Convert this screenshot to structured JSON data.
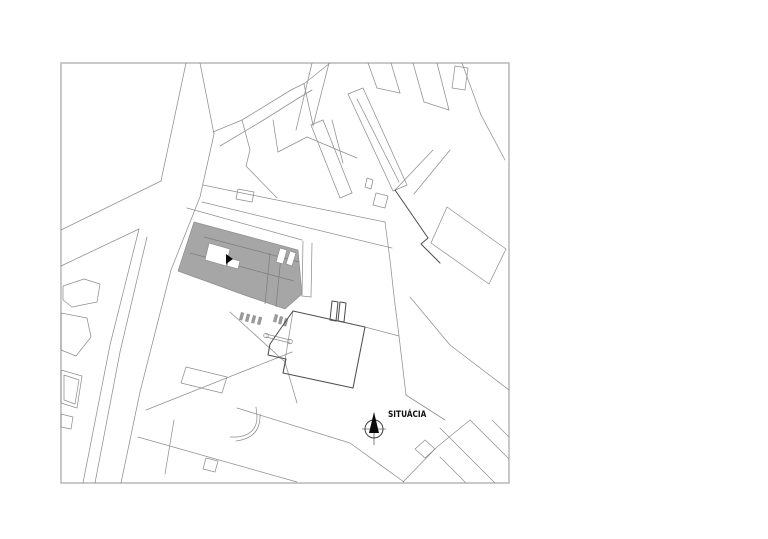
{
  "plan": {
    "label": "SITUÁCIA",
    "colors": {
      "background": "#ffffff",
      "frame_stroke": "#b2b2b2",
      "parcel_stroke": "#8f8f8f",
      "dark_stroke": "#4f4f4f",
      "highlight_fill": "#a6a6a6",
      "ink": "#0a0a0a"
    },
    "geometry": {
      "frame": {
        "x": 61,
        "y": 63,
        "w": 448,
        "h": 420
      },
      "label_pos": {
        "x": 388,
        "y": 417,
        "condense": 0.82
      },
      "north": {
        "cx": 374,
        "cy": 429,
        "r": 9,
        "hline": [
          [
            362,
            429
          ],
          [
            386,
            429
          ]
        ],
        "vline": [
          [
            374,
            413
          ],
          [
            374,
            445
          ]
        ],
        "needle": [
          [
            374,
            412
          ],
          [
            379,
            433
          ],
          [
            369,
            433
          ]
        ]
      },
      "gray_poly": [
        [
          194,
          222
        ],
        [
          298,
          250
        ],
        [
          302,
          294
        ],
        [
          285,
          309
        ],
        [
          247,
          296
        ],
        [
          178,
          271
        ]
      ],
      "white_polys": [
        [
          [
            209,
            243
          ],
          [
            230,
            249
          ],
          [
            226,
            266
          ],
          [
            205,
            260
          ]
        ],
        [
          [
            229,
            258
          ],
          [
            240,
            261
          ],
          [
            238,
            269
          ],
          [
            227,
            266
          ]
        ],
        [
          [
            280,
            248
          ],
          [
            287,
            250
          ],
          [
            283,
            264
          ],
          [
            276,
            262
          ]
        ],
        [
          [
            290,
            251
          ],
          [
            296,
            253
          ],
          [
            292,
            266
          ],
          [
            286,
            264
          ]
        ]
      ],
      "entrance_triangle": [
        [
          226,
          254
        ],
        [
          233,
          259
        ],
        [
          226,
          264
        ]
      ],
      "interior_lines": [
        [
          [
            204,
            237
          ],
          [
            299,
            262
          ]
        ],
        [
          [
            190,
            253
          ],
          [
            294,
            281
          ]
        ],
        [
          [
            270,
            253
          ],
          [
            265,
            304
          ]
        ],
        [
          [
            281,
            256
          ],
          [
            276,
            307
          ]
        ]
      ],
      "lines": [
        [
          [
            186,
            63
          ],
          [
            161,
            181
          ]
        ],
        [
          [
            200,
            63
          ],
          [
            214,
            134
          ]
        ],
        [
          [
            161,
            181
          ],
          [
            61,
            230
          ]
        ],
        [
          [
            139,
            229
          ],
          [
            61,
            266
          ]
        ],
        [
          [
            139,
            229
          ],
          [
            110,
            345
          ],
          [
            83,
            483
          ]
        ],
        [
          [
            147,
            237
          ],
          [
            120,
            352
          ],
          [
            95,
            483
          ]
        ],
        [
          [
            214,
            134
          ],
          [
            200,
            197
          ],
          [
            171,
            270
          ],
          [
            140,
            392
          ],
          [
            121,
            483
          ]
        ],
        [
          [
            213,
            132
          ],
          [
            242,
            120
          ],
          [
            291,
            90
          ],
          [
            305,
            83
          ]
        ],
        [
          [
            305,
            83
          ],
          [
            330,
            63
          ]
        ],
        [
          [
            220,
            146
          ],
          [
            262,
            121
          ],
          [
            297,
            99
          ],
          [
            312,
            90
          ]
        ],
        [
          [
            304,
            84
          ],
          [
            313,
            125
          ]
        ],
        [
          [
            242,
            120
          ],
          [
            250,
            150
          ],
          [
            246,
            166
          ],
          [
            277,
            198
          ]
        ],
        [
          [
            273,
            120
          ],
          [
            278,
            152
          ]
        ],
        [
          [
            278,
            152
          ],
          [
            307,
            137
          ]
        ],
        [
          [
            307,
            137
          ],
          [
            357,
            158
          ]
        ],
        [
          [
            332,
            120
          ],
          [
            343,
            163
          ]
        ],
        [
          [
            312,
            63
          ],
          [
            296,
            130
          ]
        ],
        [
          [
            329,
            63
          ],
          [
            313,
            126
          ]
        ],
        [
          [
            311,
            125
          ],
          [
            340,
            198
          ]
        ],
        [
          [
            323,
            120
          ],
          [
            352,
            193
          ]
        ],
        [
          [
            311,
            125
          ],
          [
            323,
            120
          ]
        ],
        [
          [
            340,
            198
          ],
          [
            352,
            193
          ]
        ],
        [
          [
            357,
            99
          ],
          [
            399,
            182
          ]
        ],
        [
          [
            368,
            63
          ],
          [
            377,
            88
          ]
        ],
        [
          [
            391,
            63
          ],
          [
            400,
            93
          ]
        ],
        [
          [
            377,
            88
          ],
          [
            400,
            93
          ]
        ],
        [
          [
            413,
            63
          ],
          [
            424,
            102
          ]
        ],
        [
          [
            437,
            63
          ],
          [
            449,
            110
          ]
        ],
        [
          [
            424,
            102
          ],
          [
            449,
            110
          ]
        ],
        [
          [
            462,
            63
          ],
          [
            481,
            115
          ]
        ],
        [
          [
            481,
            115
          ],
          [
            505,
            160
          ]
        ],
        [
          [
            433,
            150
          ],
          [
            395,
            190
          ]
        ],
        [
          [
            450,
            150
          ],
          [
            414,
            194
          ]
        ],
        [
          [
            385,
            222
          ],
          [
            390,
            260
          ],
          [
            394,
            296
          ],
          [
            399,
            336
          ]
        ],
        [
          [
            399,
            336
          ],
          [
            365,
            327
          ]
        ],
        [
          [
            399,
            336
          ],
          [
            406,
            395
          ]
        ],
        [
          [
            406,
            395
          ],
          [
            445,
            420
          ]
        ],
        [
          [
            410,
            297
          ],
          [
            450,
            345
          ],
          [
            509,
            390
          ]
        ],
        [
          [
            403,
            482
          ],
          [
            437,
            447
          ],
          [
            470,
            420
          ]
        ],
        [
          [
            440,
            428
          ],
          [
            495,
            483
          ]
        ],
        [
          [
            470,
            420
          ],
          [
            509,
            459
          ]
        ],
        [
          [
            492,
            420
          ],
          [
            509,
            437
          ]
        ],
        [
          [
            440,
            457
          ],
          [
            466,
            483
          ]
        ],
        [
          [
            203,
            185
          ],
          [
            385,
            222
          ]
        ],
        [
          [
            202,
            202
          ],
          [
            392,
            248
          ]
        ],
        [
          [
            187,
            208
          ],
          [
            302,
            240
          ]
        ],
        [
          [
            303,
            241
          ],
          [
            302,
            296
          ]
        ],
        [
          [
            312,
            243
          ],
          [
            311,
            297
          ]
        ],
        [
          [
            302,
            296
          ],
          [
            311,
            297
          ]
        ],
        [
          [
            146,
            410
          ],
          [
            292,
            352
          ]
        ],
        [
          [
            230,
            312
          ],
          [
            285,
            362
          ],
          [
            297,
            403
          ]
        ],
        [
          [
            237,
            408
          ],
          [
            350,
            443
          ],
          [
            404,
            482
          ]
        ],
        [
          [
            138,
            437
          ],
          [
            297,
            482
          ]
        ],
        [
          [
            174,
            420
          ],
          [
            165,
            474
          ]
        ],
        [
          [
            293,
            311
          ],
          [
            283,
            373
          ]
        ],
        [
          [
            266,
            334
          ],
          [
            290,
            340
          ]
        ],
        [
          [
            266,
            337
          ],
          [
            290,
            343
          ]
        ],
        [
          [
            257,
            417
          ],
          [
            256,
            407
          ]
        ],
        [
          [
            238,
            437
          ],
          [
            230,
            437
          ]
        ]
      ],
      "polys": [
        [
          [
            348,
            94
          ],
          [
            363,
            88
          ],
          [
            407,
            185
          ],
          [
            393,
            191
          ]
        ],
        [
          [
            455,
            66
          ],
          [
            468,
            68
          ],
          [
            465,
            90
          ],
          [
            452,
            88
          ]
        ],
        [
          [
            376,
            193
          ],
          [
            388,
            196
          ],
          [
            385,
            208
          ],
          [
            373,
            205
          ]
        ],
        [
          [
            367,
            178
          ],
          [
            373,
            180
          ],
          [
            371,
            189
          ],
          [
            365,
            187
          ]
        ],
        [
          [
            447,
            207
          ],
          [
            506,
            249
          ],
          [
            489,
            284
          ],
          [
            431,
            243
          ]
        ],
        [
          [
            425,
            440
          ],
          [
            435,
            449
          ],
          [
            425,
            458
          ],
          [
            415,
            449
          ]
        ],
        [
          [
            238,
            189
          ],
          [
            254,
            192
          ],
          [
            252,
            202
          ],
          [
            236,
            199
          ]
        ],
        [
          [
            63,
            286
          ],
          [
            84,
            279
          ],
          [
            100,
            284
          ],
          [
            97,
            302
          ],
          [
            72,
            307
          ],
          [
            63,
            300
          ]
        ],
        [
          [
            61,
            313
          ],
          [
            87,
            318
          ],
          [
            91,
            337
          ],
          [
            76,
            356
          ],
          [
            61,
            350
          ]
        ],
        [
          [
            61,
            370
          ],
          [
            82,
            376
          ],
          [
            77,
            408
          ],
          [
            61,
            403
          ]
        ],
        [
          [
            64,
            375
          ],
          [
            79,
            380
          ],
          [
            75,
            404
          ],
          [
            64,
            400
          ]
        ],
        [
          [
            61,
            414
          ],
          [
            73,
            417
          ],
          [
            71,
            429
          ],
          [
            61,
            427
          ]
        ],
        [
          [
            186,
            367
          ],
          [
            227,
            377
          ],
          [
            222,
            393
          ],
          [
            181,
            383
          ]
        ],
        [
          [
            206,
            458
          ],
          [
            218,
            461
          ],
          [
            215,
            472
          ],
          [
            203,
            469
          ]
        ]
      ],
      "dark_lines": [
        [
          [
            395,
            190
          ],
          [
            428,
            238
          ],
          [
            421,
            244
          ],
          [
            440,
            263
          ]
        ]
      ],
      "dark_polys": [
        [
          [
            293,
            311
          ],
          [
            365,
            327
          ],
          [
            353,
            388
          ],
          [
            283,
            373
          ],
          [
            286,
            359
          ],
          [
            268,
            355
          ],
          [
            270,
            344
          ],
          [
            288,
            318
          ]
        ],
        [
          [
            332,
            301
          ],
          [
            338,
            302
          ],
          [
            336,
            321
          ],
          [
            330,
            320
          ]
        ],
        [
          [
            340,
            302
          ],
          [
            346,
            303
          ],
          [
            344,
            322
          ],
          [
            338,
            321
          ]
        ]
      ],
      "paths": [
        "M257,417 Q257,434 238,437",
        "M260,414 Q261,438 236,441"
      ],
      "circles": [
        [
          266,
          335.5,
          2.3
        ],
        [
          290,
          341.5,
          2.3
        ]
      ],
      "ticks": [
        [
          241,
          312
        ],
        [
          247,
          313.5
        ],
        [
          253,
          315
        ],
        [
          259,
          316.5
        ],
        [
          275,
          314
        ],
        [
          280,
          316
        ],
        [
          285,
          318
        ]
      ]
    }
  }
}
